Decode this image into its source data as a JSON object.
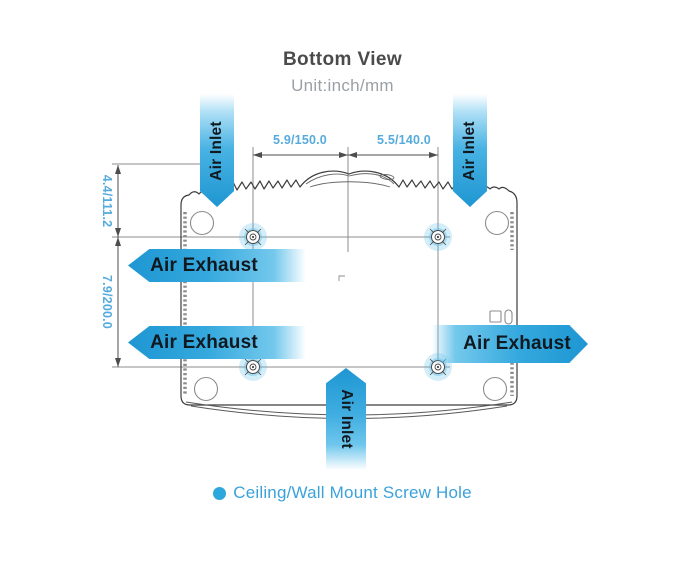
{
  "title": "Bottom View",
  "subtitle": "Unit:inch/mm",
  "dimensions": {
    "top_left": "5.9/150.0",
    "top_right": "5.5/140.0",
    "side_upper": "4.4/111.2",
    "side_lower": "7.9/200.0"
  },
  "labels": {
    "air_inlet_top_left": "Air Inlet",
    "air_inlet_top_right": "Air Inlet",
    "air_inlet_bottom": "Air Inlet",
    "air_exhaust_left_upper": "Air Exhaust",
    "air_exhaust_left_lower": "Air Exhaust",
    "air_exhaust_right": "Air Exhaust"
  },
  "legend": {
    "marker": "screw-hole-dot",
    "text": "Ceiling/Wall Mount Screw Hole"
  },
  "colors": {
    "arrow_blue_deep": "#1e96d2",
    "arrow_blue_mid": "#35a9de",
    "dimension_text_blue": "#55abdd",
    "legend_blue": "#3aa2db",
    "outline_dark": "#3c3c3c",
    "line_gray": "#8c8c8c"
  }
}
